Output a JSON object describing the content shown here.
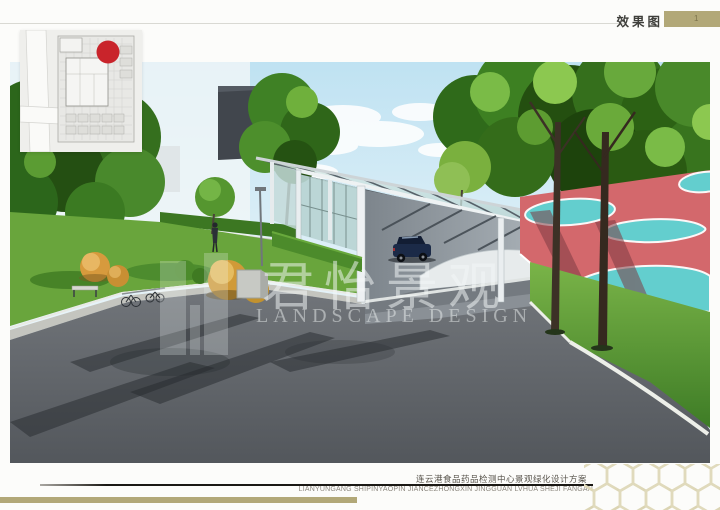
{
  "header": {
    "label": "效果图",
    "page_marker": "1",
    "accent_color": "#b2a878"
  },
  "watermark": {
    "cn": "君怡景观",
    "en": "LANDSCAPE DESIGN"
  },
  "footer": {
    "project_title_cn": "连云港食品药品检测中心景观绿化设计方案",
    "project_title_en": "LIANYUNGANG SHIPINYAOPIN JIANCEZHONGXIN JINGGUAN LVHUA SHEJI FANGAN",
    "accent_color": "#b2a878"
  },
  "inset_plan": {
    "marker_color": "#c9242b"
  },
  "scene_colors": {
    "sky": "#c2e4f2",
    "foliage": "#3d8022",
    "road": "#63676c",
    "playground_red": "#d3686c",
    "playground_cyan": "#5ed4d4",
    "grass": "#5d9c35",
    "car_body": "#1b2a47",
    "glass": "#bcd6d4"
  }
}
